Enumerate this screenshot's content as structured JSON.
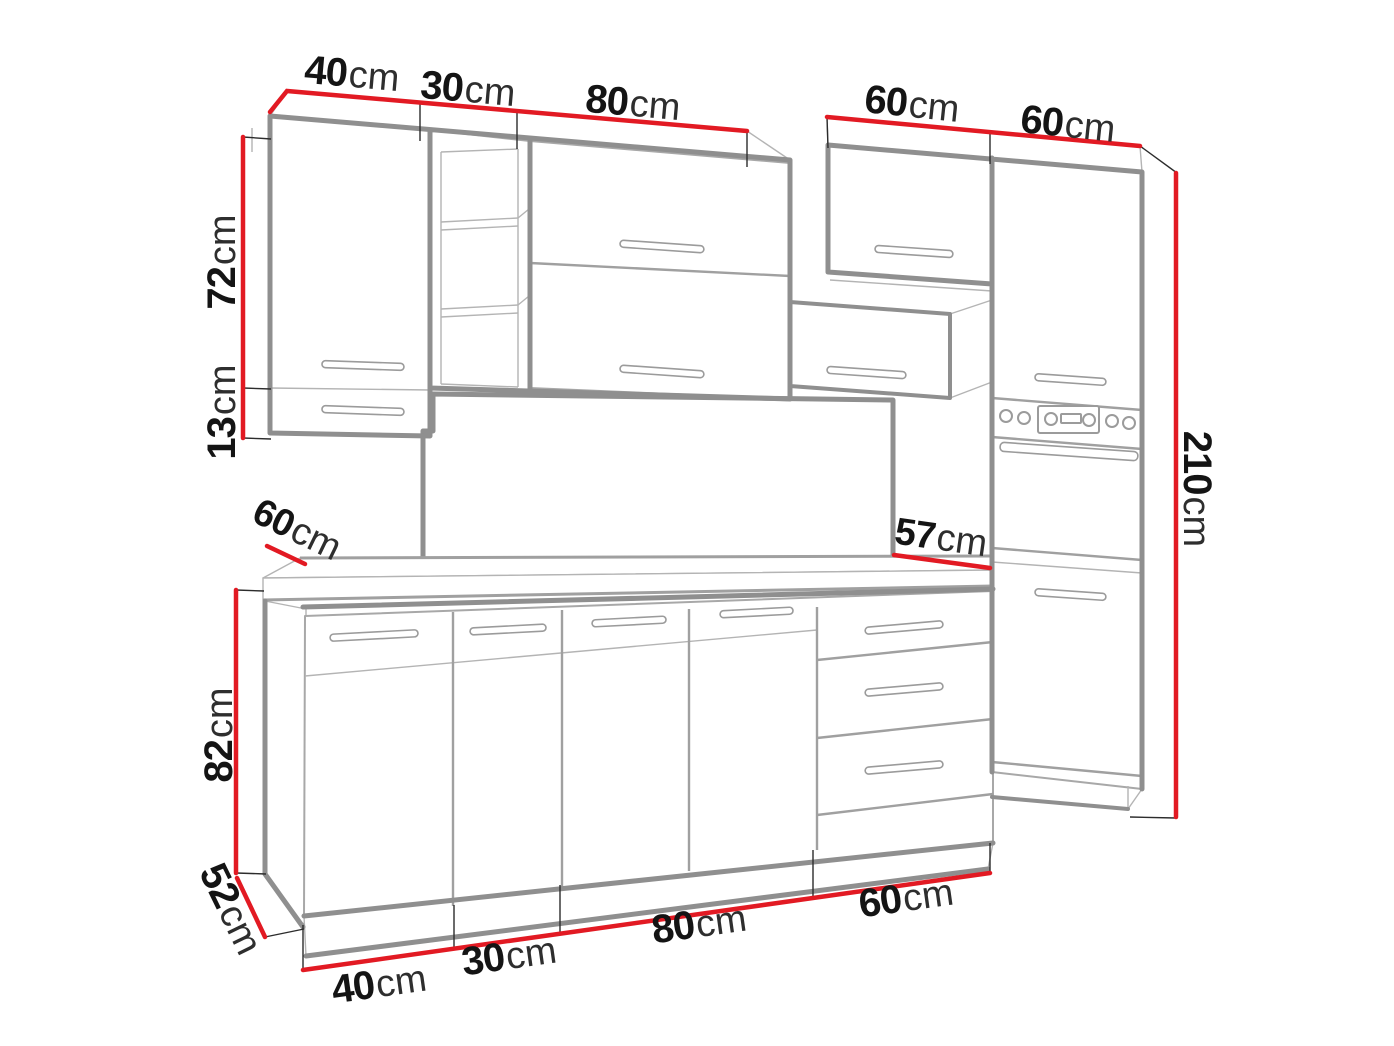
{
  "diagram": {
    "kind": "kitchen-cabinet-set-dimension-drawing",
    "unit": "cm",
    "colors": {
      "dimension_line": "#e21a23",
      "outline_heavy": "#8f8f8f",
      "outline_light": "#b4b4b4",
      "label_number": "#141414",
      "label_unit": "#2e2e2e",
      "background": "#ffffff"
    }
  },
  "labels": {
    "wall_widths": [
      {
        "value": "40",
        "unit": "cm"
      },
      {
        "value": "30",
        "unit": "cm"
      },
      {
        "value": "80",
        "unit": "cm"
      },
      {
        "value": "60",
        "unit": "cm"
      },
      {
        "value": "60",
        "unit": "cm"
      }
    ],
    "wall_cabinet_height": {
      "value": "72",
      "unit": "cm"
    },
    "wall_cabinet_extension": {
      "value": "13",
      "unit": "cm"
    },
    "total_height": {
      "value": "210",
      "unit": "cm"
    },
    "splashback_height": {
      "value": "57",
      "unit": "cm"
    },
    "worktop_depth": {
      "value": "60",
      "unit": "cm"
    },
    "base_height": {
      "value": "82",
      "unit": "cm"
    },
    "base_depth": {
      "value": "52",
      "unit": "cm"
    },
    "base_widths": [
      {
        "value": "40",
        "unit": "cm"
      },
      {
        "value": "30",
        "unit": "cm"
      },
      {
        "value": "80",
        "unit": "cm"
      },
      {
        "value": "60",
        "unit": "cm"
      }
    ]
  }
}
